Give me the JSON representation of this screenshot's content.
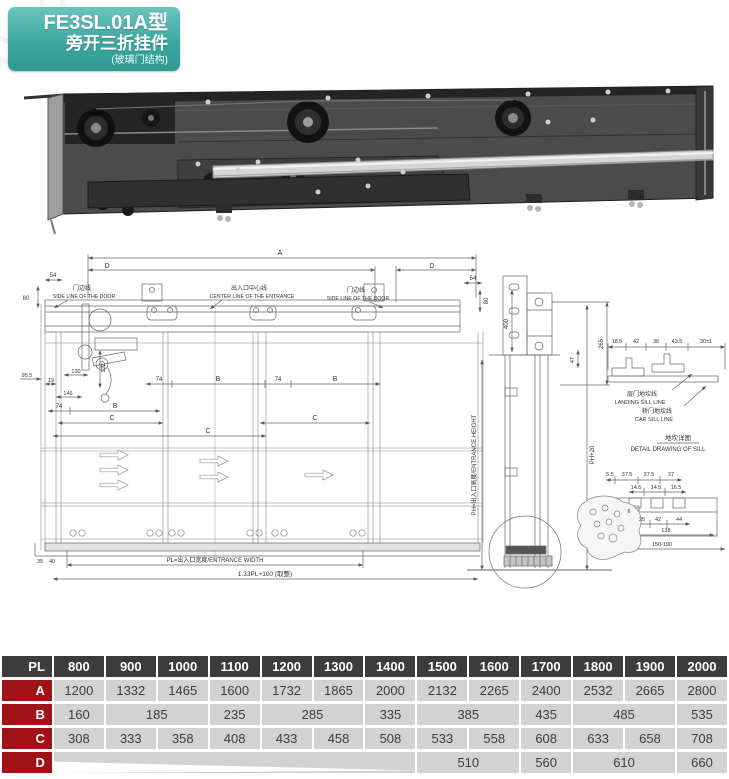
{
  "badge": {
    "model": "FE3SL.01A型",
    "name": "旁开三折挂件",
    "sub": "(玻璃门结构)"
  },
  "colors": {
    "badge_teal": "#3da89f",
    "table_header_bg": "#3c3c3c",
    "table_label_bg": "#a01218",
    "table_cell_bg": "#d2d2d2"
  },
  "drawing": {
    "dims": {
      "a": "A",
      "d": "D",
      "b": "B",
      "c": "C",
      "n54": "54",
      "n80": "80",
      "n74": "74",
      "n95_5": "95.5",
      "n19": "19",
      "n130": "130",
      "n122": "122",
      "n146": "146",
      "n35": "35",
      "n40": "40",
      "pl_width": "PL=出入口宽度/ENTRANCE WIDTH",
      "formula": "1.33PL+100 (取整)",
      "n400": "400",
      "n265": "265",
      "n47": "47",
      "ph20": "PH+20",
      "ph_height": "PH=出入口高度/ENTRANCE HEIGHT",
      "sill_row": [
        "18.5",
        "42",
        "36",
        "43.5",
        "30±1"
      ],
      "cs_row1": [
        "5.5",
        "37.5",
        "37.5",
        "37"
      ],
      "cs_row2": [
        "14.5",
        "14.5",
        "16.5"
      ],
      "cs_n6": "6",
      "cs_row3": [
        "25",
        "42",
        "44"
      ],
      "cs_138": "138",
      "cs_range": "150-190"
    },
    "labels": {
      "side_line_cn": "门边线",
      "side_line_en": "SIDE LINE OF THE DOOR",
      "center_line_cn": "出入口中心线",
      "center_line_en": "CENTER LINE OF THE ENTRANCE",
      "landing_sill_cn": "层门地坎线",
      "landing_sill_en": "LANDING SILL LINE",
      "car_sill_cn": "轿门地坎线",
      "car_sill_en": "CAR SILL LINE",
      "sill_detail_cn": "地坎详图",
      "sill_detail_en": "DETAIL DRAWING OF SILL"
    }
  },
  "table": {
    "header": [
      "PL",
      "800",
      "900",
      "1000",
      "1100",
      "1200",
      "1300",
      "1400",
      "1500",
      "1600",
      "1700",
      "1800",
      "1900",
      "2000"
    ],
    "rows": [
      {
        "label": "A",
        "cells": [
          {
            "v": "1200"
          },
          {
            "v": "1332"
          },
          {
            "v": "1465"
          },
          {
            "v": "1600"
          },
          {
            "v": "1732"
          },
          {
            "v": "1865"
          },
          {
            "v": "2000"
          },
          {
            "v": "2132"
          },
          {
            "v": "2265"
          },
          {
            "v": "2400"
          },
          {
            "v": "2532"
          },
          {
            "v": "2665"
          },
          {
            "v": "2800"
          }
        ]
      },
      {
        "label": "B",
        "cells": [
          {
            "v": "160"
          },
          {
            "v": "185",
            "span": 2
          },
          {
            "v": "235"
          },
          {
            "v": "285",
            "span": 2
          },
          {
            "v": "335"
          },
          {
            "v": "385",
            "span": 2
          },
          {
            "v": "435"
          },
          {
            "v": "485",
            "span": 2
          },
          {
            "v": "535"
          }
        ]
      },
      {
        "label": "C",
        "cells": [
          {
            "v": "308"
          },
          {
            "v": "333"
          },
          {
            "v": "358"
          },
          {
            "v": "408"
          },
          {
            "v": "433"
          },
          {
            "v": "458"
          },
          {
            "v": "508"
          },
          {
            "v": "533"
          },
          {
            "v": "558"
          },
          {
            "v": "608"
          },
          {
            "v": "633"
          },
          {
            "v": "658"
          },
          {
            "v": "708"
          }
        ]
      },
      {
        "label": "D",
        "cells": [
          {
            "v": "",
            "span": 7,
            "empty": true
          },
          {
            "v": "510",
            "span": 2
          },
          {
            "v": "560"
          },
          {
            "v": "610",
            "span": 2
          },
          {
            "v": "660"
          }
        ]
      }
    ]
  }
}
